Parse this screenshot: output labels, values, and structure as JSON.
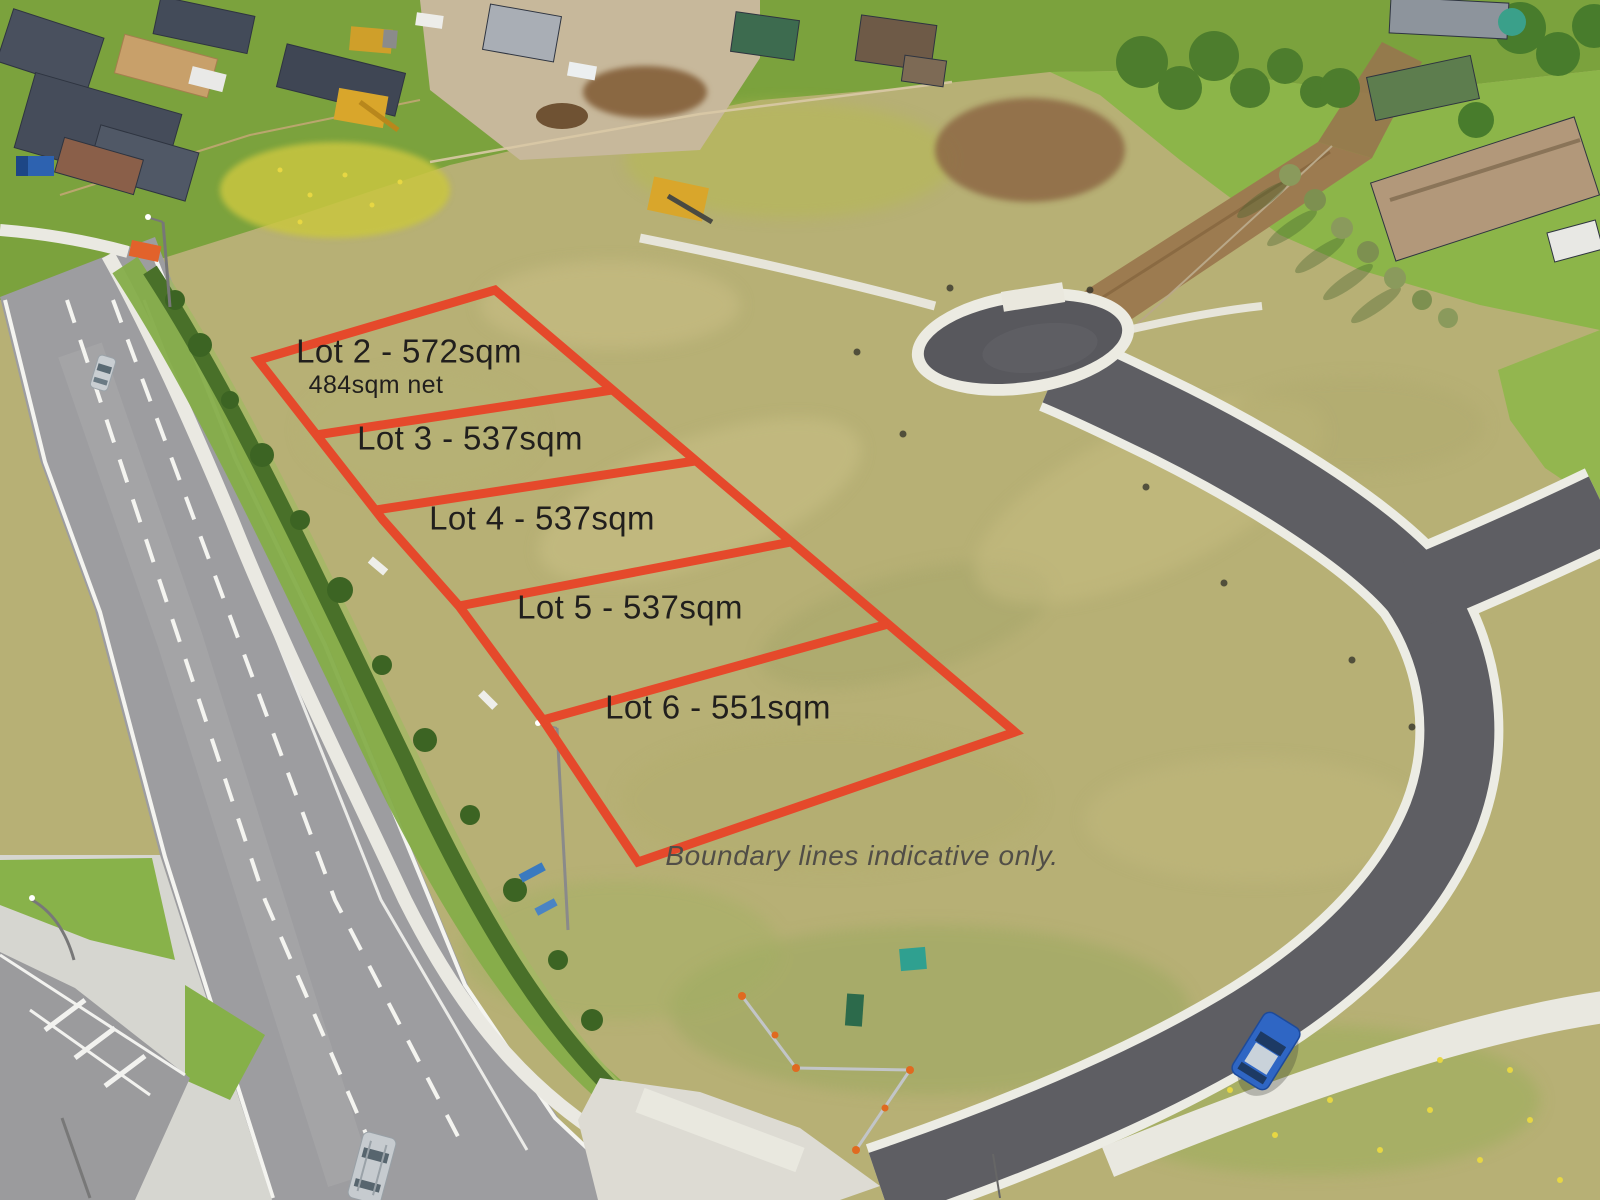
{
  "overlay": {
    "boundary_color": "#e5492b",
    "boundary_stroke_width": 9,
    "label_color": "#211f1d",
    "disclaimer_color": "#514e47",
    "outline_points": "495,290 1015,732 638,862 543,720 459,606 383,520 258,360",
    "divider_lines": [
      {
        "x1": 316,
        "y1": 435,
        "x2": 612,
        "y2": 390
      },
      {
        "x1": 376,
        "y1": 510,
        "x2": 695,
        "y2": 461
      },
      {
        "x1": 459,
        "y1": 606,
        "x2": 791,
        "y2": 542
      },
      {
        "x1": 543,
        "y1": 720,
        "x2": 888,
        "y2": 624
      }
    ],
    "lots": [
      {
        "name": "lot-2",
        "label": "Lot 2 - 572sqm",
        "x": 409,
        "y": 352,
        "sublabel": "484sqm net",
        "sub_x": 376,
        "sub_y": 385
      },
      {
        "name": "lot-3",
        "label": "Lot 3 - 537sqm",
        "x": 470,
        "y": 439
      },
      {
        "name": "lot-4",
        "label": "Lot 4 - 537sqm",
        "x": 542,
        "y": 519
      },
      {
        "name": "lot-5",
        "label": "Lot 5 - 537sqm",
        "x": 630,
        "y": 608
      },
      {
        "name": "lot-6",
        "label": "Lot 6 - 551sqm",
        "x": 718,
        "y": 708
      }
    ],
    "disclaimer": {
      "text": "Boundary lines indicative only.",
      "x": 862,
      "y": 856
    }
  }
}
